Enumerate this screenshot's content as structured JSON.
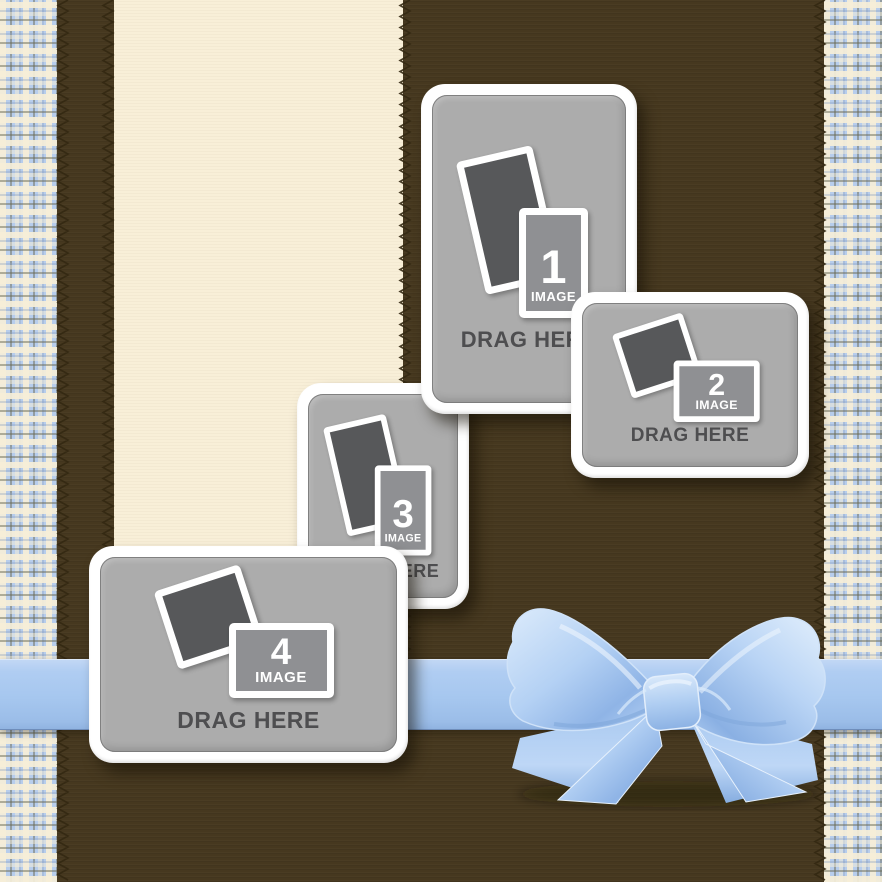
{
  "template": {
    "name": "photo-collage-drag-template",
    "placeholders": [
      {
        "id": "1",
        "number": "1",
        "image_label": "IMAGE",
        "drag_label": "DRAG HERE",
        "orientation": "portrait",
        "icon": "photo-stack-icon"
      },
      {
        "id": "2",
        "number": "2",
        "image_label": "IMAGE",
        "drag_label": "DRAG HERE",
        "orientation": "landscape",
        "icon": "photo-stack-icon"
      },
      {
        "id": "3",
        "number": "3",
        "image_label": "IMAGE",
        "drag_label": "DRAG HERE",
        "orientation": "portrait",
        "icon": "photo-stack-icon"
      },
      {
        "id": "4",
        "number": "4",
        "image_label": "IMAGE",
        "drag_label": "DRAG HERE",
        "orientation": "landscape",
        "icon": "photo-stack-icon"
      }
    ],
    "decorations": {
      "bow": "satin-bow-icon",
      "ribbon": "horizontal-ribbon-band",
      "stitches": "zigzag-stitching"
    }
  },
  "colors": {
    "background_brown": "#46381f",
    "cream_stripe": "#f8eed6",
    "plaid_blue": "#b7cdec",
    "plaid_cream": "#f4ecd6",
    "stitch_thread": "#332812",
    "ribbon_blue": "#a6c7ef",
    "bow_highlight": "#dcebfb",
    "bow_shadow": "#7fa8dc",
    "card_frame_white": "#ffffff",
    "card_panel_gray": "#acacac",
    "icon_dark_gray": "#57585a",
    "icon_mid_gray": "#8f9093",
    "drag_text_gray": "#4e4e50"
  }
}
